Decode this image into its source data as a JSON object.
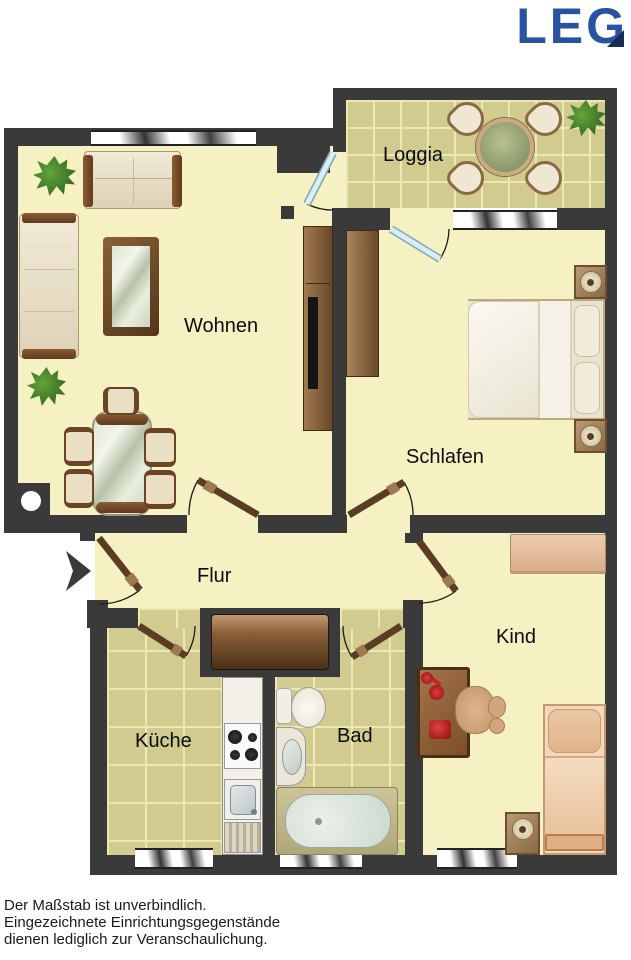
{
  "logo": {
    "text": "LEG",
    "color": "#2a52a2",
    "accent_color": "#1b2a52"
  },
  "rooms": {
    "loggia": {
      "label": "Loggia"
    },
    "wohnen": {
      "label": "Wohnen"
    },
    "schlafen": {
      "label": "Schlafen"
    },
    "flur": {
      "label": "Flur"
    },
    "kind": {
      "label": "Kind"
    },
    "kueche": {
      "label": "Küche"
    },
    "bad": {
      "label": "Bad"
    }
  },
  "footer": {
    "line1": "Der Maßstab ist unverbindlich.",
    "line2": "Eingezeichnete Einrichtungsgegenstände",
    "line3": "dienen lediglich zur Veranschaulichung."
  }
}
